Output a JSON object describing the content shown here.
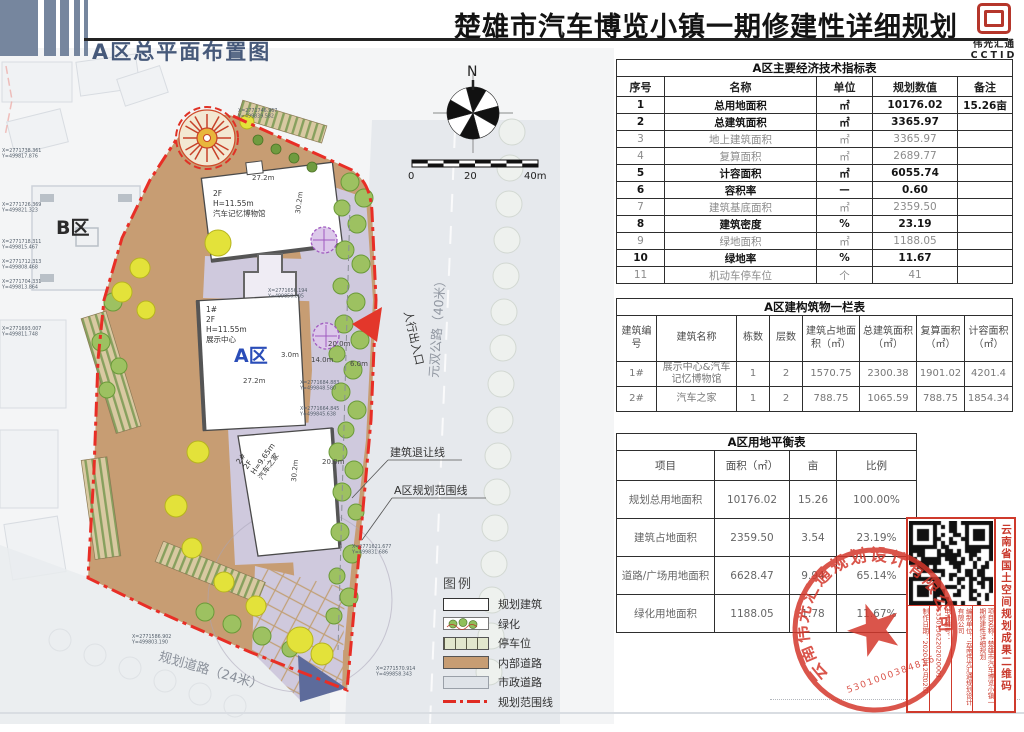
{
  "header": {
    "title": "楚雄市汽车博览小镇一期修建性详细规划",
    "logo_text": "伟光汇通",
    "logo_sub": "CCTID",
    "drawing_title": "A区总平面布置图"
  },
  "plan": {
    "zone_a": "A区",
    "zone_b": "B区",
    "north_label": "N",
    "scale_labels": [
      "0",
      "20",
      "40m"
    ],
    "entrance_label": "人行出入口",
    "road_east": "元双公路（40米）",
    "road_south": "规划道路（24米）",
    "setback_label": "建筑退让线",
    "boundary_label": "A区规划范围线",
    "museum_label": [
      "2F",
      "H=11.55m",
      "汽车记忆博物馆"
    ],
    "exhibit_label": [
      "1#",
      "2F",
      "H=11.55m",
      "展示中心"
    ],
    "autohome_label": [
      "2#",
      "2F",
      "H=9.65m",
      "汽车之家"
    ],
    "dims": [
      "27.2m",
      "30.2m",
      "27.2m",
      "3.0m",
      "14.0m",
      "6.0m",
      "20.0m",
      "20.0m",
      "30.2m"
    ],
    "coords": [
      {
        "a": "X=2771746.967",
        "b": "Y=499839.582"
      },
      {
        "a": "X=2771738.361",
        "b": "Y=499817.876"
      },
      {
        "a": "X=2771726.369",
        "b": "Y=499821.323"
      },
      {
        "a": "X=2771718.311",
        "b": "Y=499815.467"
      },
      {
        "a": "X=2771712.313",
        "b": "Y=499808.468"
      },
      {
        "a": "X=2771704.331",
        "b": "Y=499813.864"
      },
      {
        "a": "X=2771693.007",
        "b": "Y=499811.748"
      },
      {
        "a": "X=2771684.883",
        "b": "Y=499848.580"
      },
      {
        "a": "X=2771664.845",
        "b": "Y=499845.638"
      },
      {
        "a": "X=2771656.194",
        "b": "Y=499850.805"
      },
      {
        "a": "X=2771621.677",
        "b": "Y=499831.686"
      },
      {
        "a": "X=2771586.902",
        "b": "Y=499803.190"
      },
      {
        "a": "X=2771570.914",
        "b": "Y=499858.343"
      }
    ]
  },
  "legend": {
    "title": "图例",
    "items": [
      {
        "label": "规划建筑",
        "type": "building"
      },
      {
        "label": "绿化",
        "type": "green"
      },
      {
        "label": "停车位",
        "type": "parking"
      },
      {
        "label": "内部道路",
        "type": "internal-road"
      },
      {
        "label": "市政道路",
        "type": "municipal-road"
      },
      {
        "label": "规划范围线",
        "type": "boundary"
      }
    ]
  },
  "tables": {
    "indicators": {
      "title": "A区主要经济技术指标表",
      "headers": [
        "序号",
        "名称",
        "单位",
        "规划数值",
        "备注"
      ],
      "rows": [
        {
          "c": [
            "1",
            "总用地面积",
            "㎡",
            "10176.02",
            "15.26亩"
          ],
          "b": 1
        },
        {
          "c": [
            "2",
            "总建筑面积",
            "㎡",
            "3365.97",
            ""
          ],
          "b": 1
        },
        {
          "c": [
            "3",
            "地上建筑面积",
            "㎡",
            "3365.97",
            ""
          ]
        },
        {
          "c": [
            "4",
            "复算面积",
            "㎡",
            "2689.77",
            ""
          ]
        },
        {
          "c": [
            "5",
            "计容面积",
            "㎡",
            "6055.74",
            ""
          ],
          "b": 1
        },
        {
          "c": [
            "6",
            "容积率",
            "—",
            "0.60",
            ""
          ],
          "b": 1
        },
        {
          "c": [
            "7",
            "建筑基底面积",
            "㎡",
            "2359.50",
            ""
          ]
        },
        {
          "c": [
            "8",
            "建筑密度",
            "%",
            "23.19",
            ""
          ],
          "b": 1
        },
        {
          "c": [
            "9",
            "绿地面积",
            "㎡",
            "1188.05",
            ""
          ]
        },
        {
          "c": [
            "10",
            "绿地率",
            "%",
            "11.67",
            ""
          ],
          "b": 1
        },
        {
          "c": [
            "11",
            "机动车停车位",
            "个",
            "41",
            ""
          ]
        }
      ]
    },
    "buildings": {
      "title": "A区建构筑物一栏表",
      "headers": [
        "建筑编号",
        "建筑名称",
        "栋数",
        "层数",
        "建筑占地面积（㎡）",
        "总建筑面积（㎡）",
        "复算面积（㎡）",
        "计容面积（㎡）"
      ],
      "rows": [
        [
          "1#",
          "展示中心&汽车记忆博物馆",
          "1",
          "2",
          "1570.75",
          "2300.38",
          "1901.02",
          "4201.4"
        ],
        [
          "2#",
          "汽车之家",
          "1",
          "2",
          "788.75",
          "1065.59",
          "788.75",
          "1854.34"
        ]
      ]
    },
    "land_balance": {
      "title": "A区用地平衡表",
      "headers": [
        "项目",
        "面积（㎡）",
        "亩",
        "比例"
      ],
      "rows": [
        [
          "规划总用地面积",
          "10176.02",
          "15.26",
          "100.00%"
        ],
        [
          "建筑占地面积",
          "2359.50",
          "3.54",
          "23.19%"
        ],
        [
          "道路/广场用地面积",
          "6628.47",
          "9.94",
          "65.14%"
        ],
        [
          "绿化用地面积",
          "1188.05",
          "1.78",
          "11.67%"
        ]
      ]
    }
  },
  "qr_block": {
    "side_label": "云南省国土空间规划成果二维码",
    "columns": [
      "制作日期：2020年12月02日",
      "电子编号：53301362202020001",
      "编制单位：云南伟光汇通规划设计有限公司",
      "项目名称：楚雄市汽车博览小镇一期修建性详细规划"
    ]
  },
  "stamp": {
    "company": "云南伟光汇通规划设计有限公司",
    "number": "5301000384816"
  },
  "colors": {
    "boundary_red": "#e82e26",
    "internal_road_tan": "#c79d73",
    "plaza_lavender": "#cfc9dd",
    "municipal_gray": "#e6e9ed",
    "tree_green": "#9dc161",
    "tree_yellow": "#e3e23a",
    "zone_label_blue": "#2a4db8",
    "header_bar_blue": "#76869e",
    "stamp_red": "#cf3a2c"
  }
}
